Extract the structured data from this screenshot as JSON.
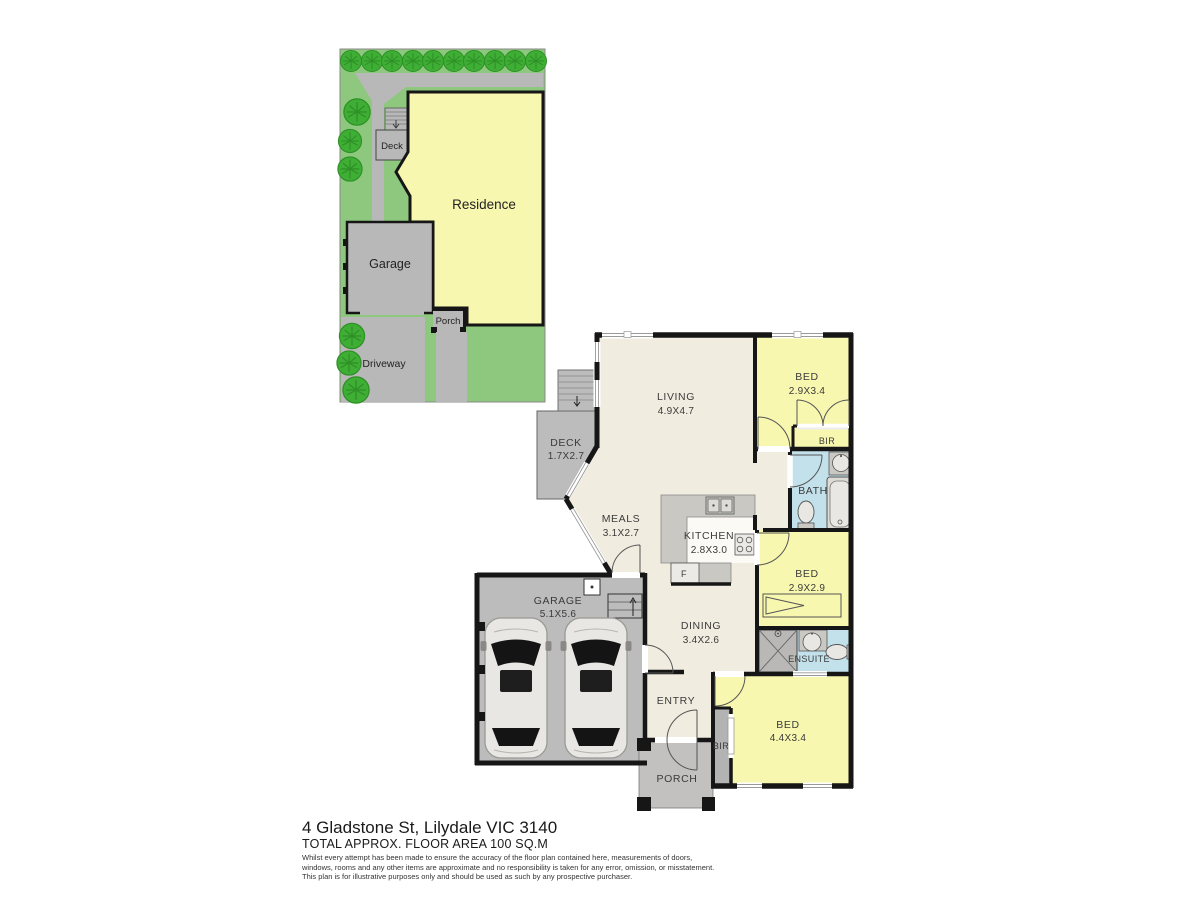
{
  "site_plan": {
    "labels": {
      "deck": "Deck",
      "residence": "Residence",
      "garage": "Garage",
      "porch": "Porch",
      "driveway": "Driveway"
    }
  },
  "floor_plan": {
    "living": {
      "name": "LIVING",
      "dims": "4.9X4.7"
    },
    "deck": {
      "name": "DECK",
      "dims": "1.7X2.7"
    },
    "meals": {
      "name": "MEALS",
      "dims": "3.1X2.7"
    },
    "kitchen": {
      "name": "KITCHEN",
      "dims": "2.8X3.0"
    },
    "fridge": "F",
    "dining": {
      "name": "DINING",
      "dims": "3.4X2.6"
    },
    "garage": {
      "name": "GARAGE",
      "dims": "5.1X5.6"
    },
    "entry": "ENTRY",
    "porch": "PORCH",
    "bed1": {
      "name": "BED",
      "dims": "2.9X3.4"
    },
    "bir1": "BIR",
    "bath": "BATH",
    "bed2": {
      "name": "BED",
      "dims": "2.9X2.9"
    },
    "ensuite": "ENSUITE",
    "bed3": {
      "name": "BED",
      "dims": "4.4X3.4"
    },
    "bir2": "BIR"
  },
  "footer": {
    "address": "4 Gladstone St, Lilydale VIC 3140",
    "floor_area": "TOTAL APPROX. FLOOR AREA 100 SQ.M",
    "disclaimer_lines": [
      "Whilst every attempt has been made to ensure the accuracy of the floor plan contained here, measurements of doors,",
      "windows, rooms and any other items are approximate and no responsibility is taken for any error, omission, or misstatement.",
      "This plan is for illustrative purposes only and should be used as such by any prospective purchaser."
    ]
  },
  "colors": {
    "grass": "#8dc87e",
    "tree": "#3fae35",
    "residence_yellow": "#f8f7b0",
    "paving_gray": "#b8b8b8",
    "floor_cream": "#f1ece0",
    "room_yellow": "#f8f7b0",
    "wet_area_blue": "#c3e1eb",
    "garage_gray": "#bcbcbc",
    "wall": "#161616"
  }
}
